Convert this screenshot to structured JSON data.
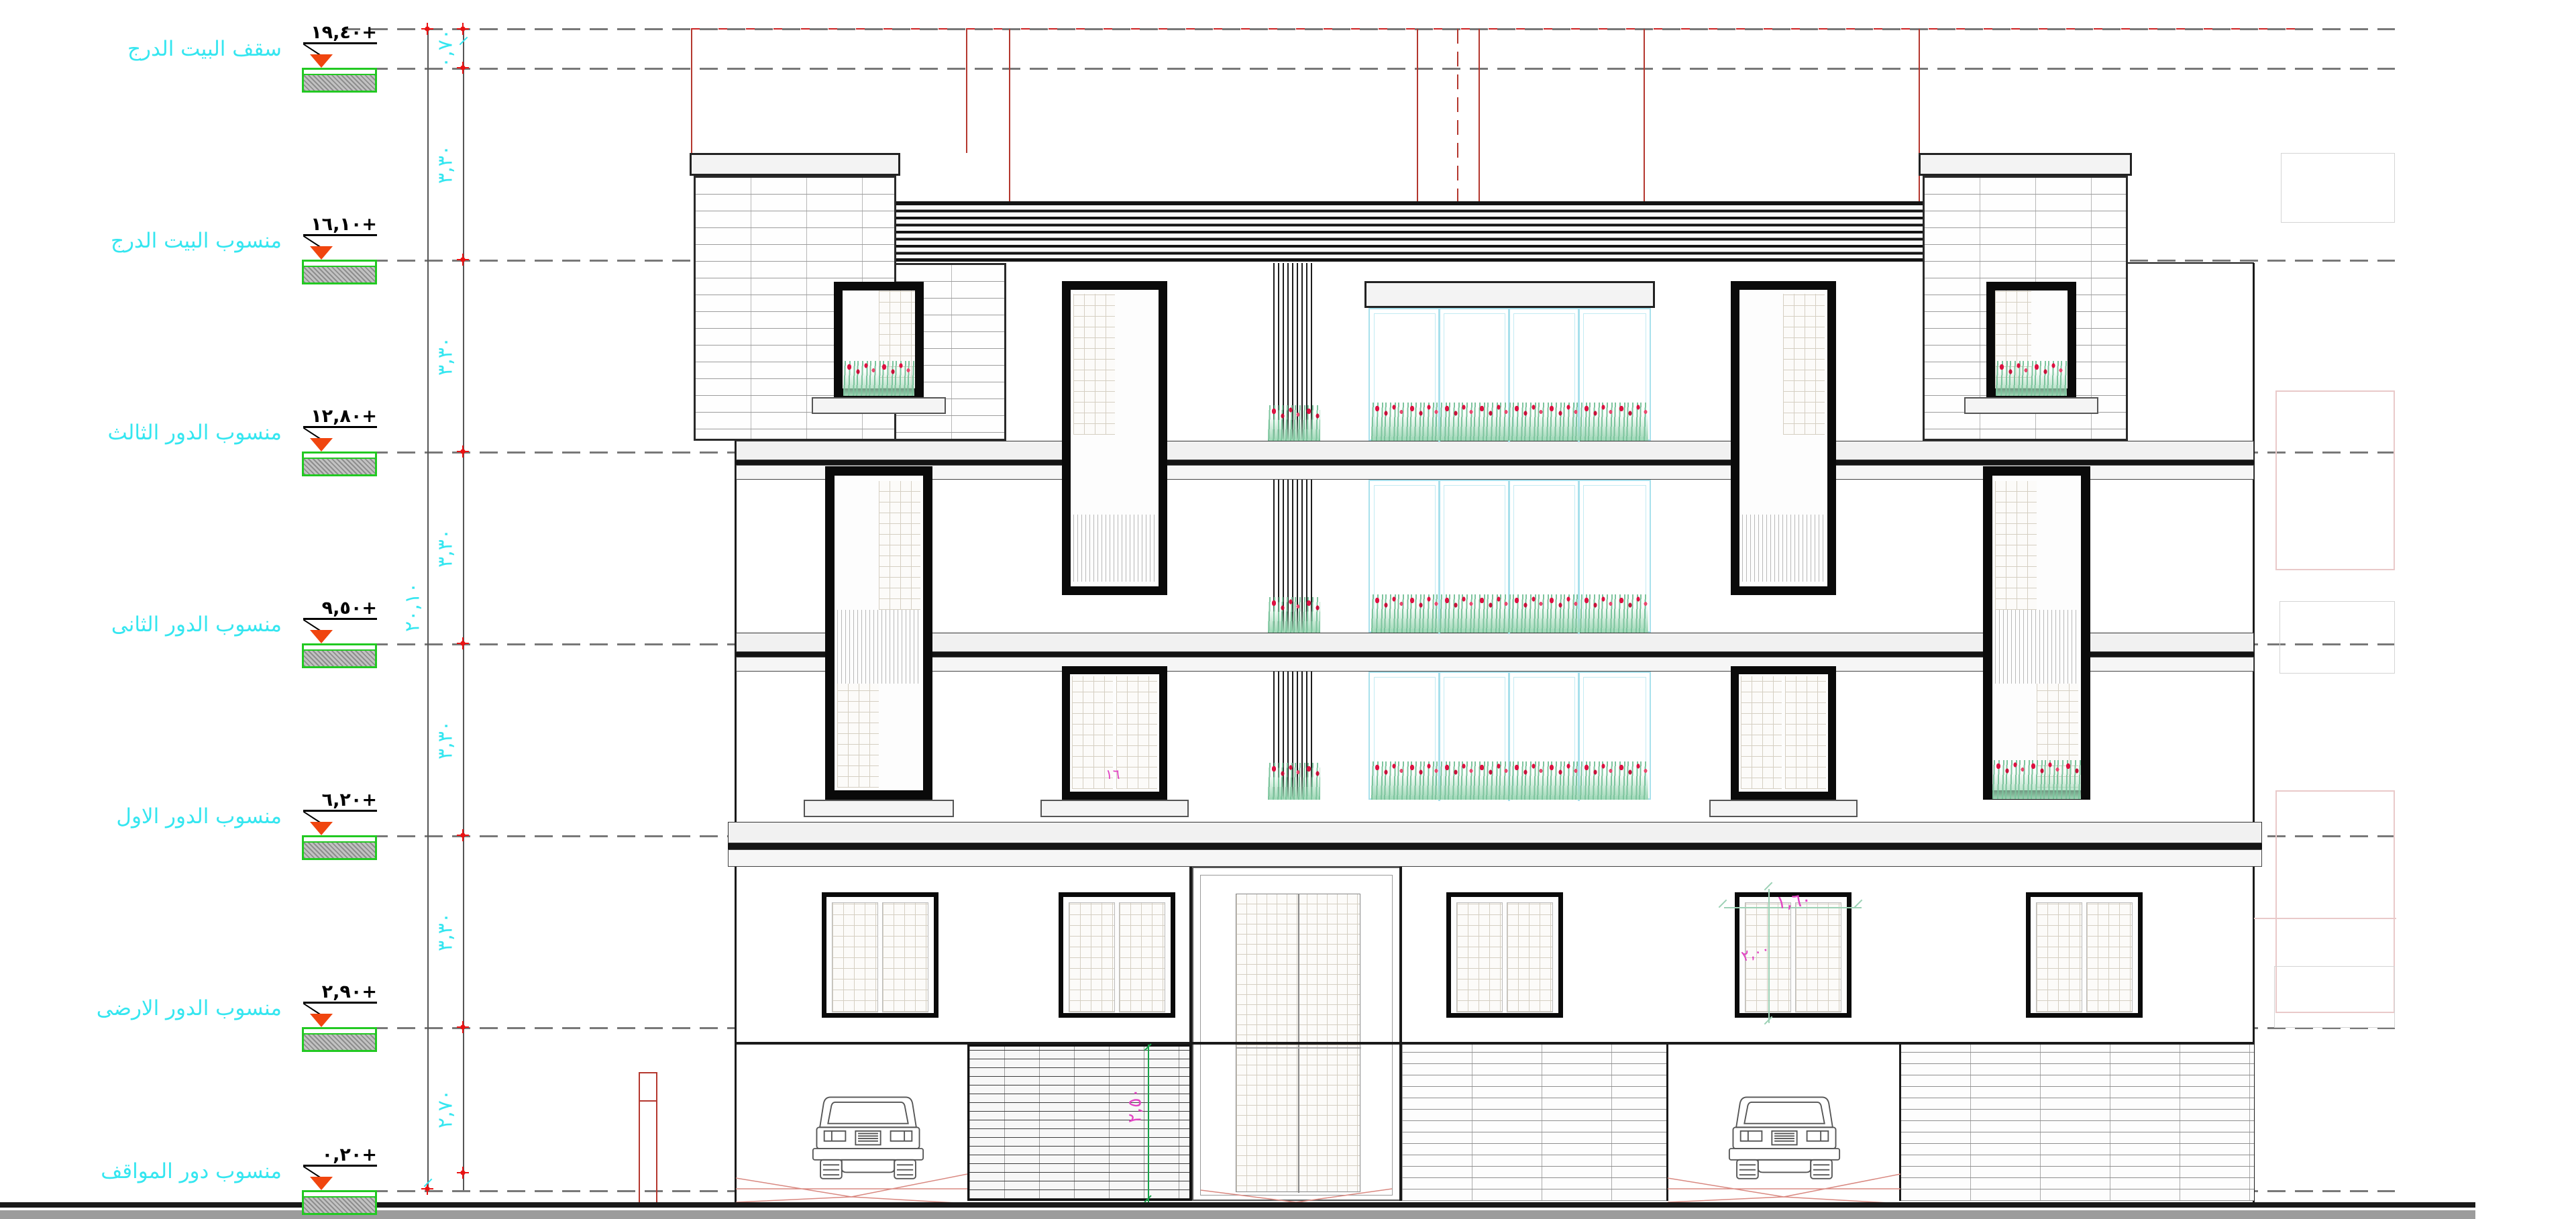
{
  "levels": [
    {
      "name": "سقف البيت الدرج",
      "value": "١٩,٤٠+"
    },
    {
      "name": "منسوب البيت الدرج",
      "value": "١٦,١٠+"
    },
    {
      "name": "منسوب الدور الثالث",
      "value": "١٢,٨٠+"
    },
    {
      "name": "منسوب الدور الثانى",
      "value": "٩,٥٠+"
    },
    {
      "name": "منسوب الدور الاول",
      "value": "٦,٢٠+"
    },
    {
      "name": "منسوب الدور الارضى",
      "value": "٢,٩٠+"
    },
    {
      "name": "منسوب دور المواقف",
      "value": "٠,٢٠+"
    }
  ],
  "dimensions": {
    "overall": "٢٠,١٠",
    "segments": [
      {
        "label": "٠,٧٠"
      },
      {
        "label": "٣,٣٠"
      },
      {
        "label": "٣,٣٠"
      },
      {
        "label": "٣,٣٠"
      },
      {
        "label": "٣,٣٠"
      },
      {
        "label": "٣,٣٠"
      },
      {
        "label": "٢,٧٠"
      }
    ],
    "garage_door_height": "٢,٥٠"
  },
  "annotations": {
    "window_width": "١,٦٠",
    "window_note": "٢,٠٠",
    "floor_note": "١٦"
  },
  "colors": {
    "cyan": "#35e6f0",
    "green": "#22c922",
    "orange": "#f0450f",
    "redmark": "#ea1212",
    "redline": "#b4372e",
    "reddash": "#cc2222",
    "magenta": "#e243c3",
    "teal": "#9cd1b5",
    "flower": "#dd1141",
    "leaf": "#7cc49d",
    "glaze": "#a8e0ec",
    "dash": "#787878",
    "ink": "#1a1a1a",
    "pave": "#9c9c9c",
    "ghost": "#e9c9c9"
  }
}
